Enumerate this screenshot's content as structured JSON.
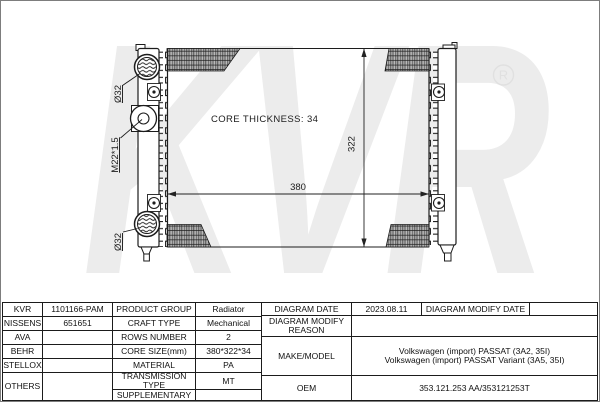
{
  "page": {
    "background": "#ffffff",
    "border_color": "#7d7d7d",
    "line_color": "#1c1c1c",
    "watermark_color": "#ececec"
  },
  "diagram": {
    "core_thickness_text": "CORE THICKNESS: 34",
    "width_dimension": "380",
    "height_dimension": "322",
    "inlet_diameter_label": "Ø32",
    "outlet_diameter_label": "Ø32",
    "filler_thread_label": "M22*1.5",
    "watermark_text": "KVR",
    "registered_symbol": "R"
  },
  "table": {
    "brands": [
      {
        "name": "KVR",
        "code": "1101166-PAM"
      },
      {
        "name": "NISSENS",
        "code": "651651"
      },
      {
        "name": "AVA",
        "code": ""
      },
      {
        "name": "BEHR",
        "code": ""
      },
      {
        "name": "STELLOX",
        "code": ""
      },
      {
        "name": "OTHERS",
        "code": ""
      }
    ],
    "specs": [
      {
        "label": "PRODUCT GROUP",
        "value": "Radiator"
      },
      {
        "label": "CRAFT TYPE",
        "value": "Mechanical"
      },
      {
        "label": "ROWS NUMBER",
        "value": "2"
      },
      {
        "label": "CORE SIZE(mm)",
        "value": "380*322*34"
      },
      {
        "label": "MATERIAL",
        "value": "PA"
      },
      {
        "label": "TRANSMISSION TYPE",
        "value": "MT"
      },
      {
        "label": "SUPPLEMENTARY",
        "value": ""
      }
    ],
    "right": {
      "date_label": "DIAGRAM DATE",
      "date_value": "2023.08.11",
      "modify_date_label": "DIAGRAM MODIFY DATE",
      "modify_date_value": "",
      "reason_label": "DIAGRAM MODIFY REASON",
      "reason_value": "",
      "make_label": "MAKE/MODEL",
      "make_line1": "Volkswagen (import) PASSAT (3A2, 35I)",
      "make_line2": "Volkswagen (import) PASSAT Variant (3A5, 35I)",
      "oem_label": "OEM",
      "oem_value": "353.121.253 AA/353121253T"
    }
  }
}
